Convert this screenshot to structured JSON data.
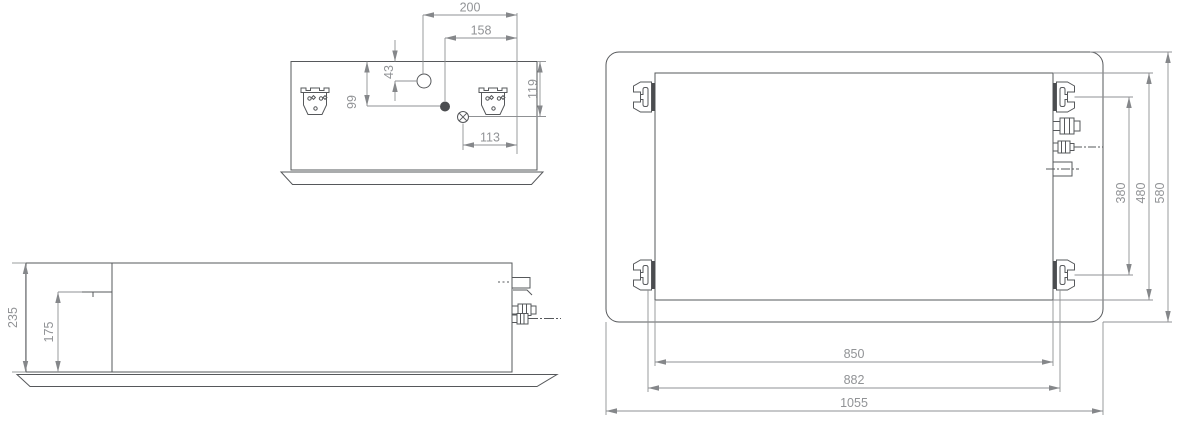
{
  "drawing": {
    "side_view": {
      "dims": {
        "d200": "200",
        "d158": "158",
        "d43": "43",
        "d99": "99",
        "d119": "119",
        "d113": "113"
      }
    },
    "front_view": {
      "dims": {
        "d235": "235",
        "d175": "175"
      }
    },
    "plan_view": {
      "dims": {
        "d380": "380",
        "d480": "480",
        "d580": "580",
        "d850": "850",
        "d882": "882",
        "d1055": "1055"
      }
    },
    "colors": {
      "object_line": "#56585b",
      "dimension_line": "#8f9194",
      "dimension_text": "#919396",
      "dark_fill": "#4b4d50",
      "background": "#ffffff"
    }
  }
}
